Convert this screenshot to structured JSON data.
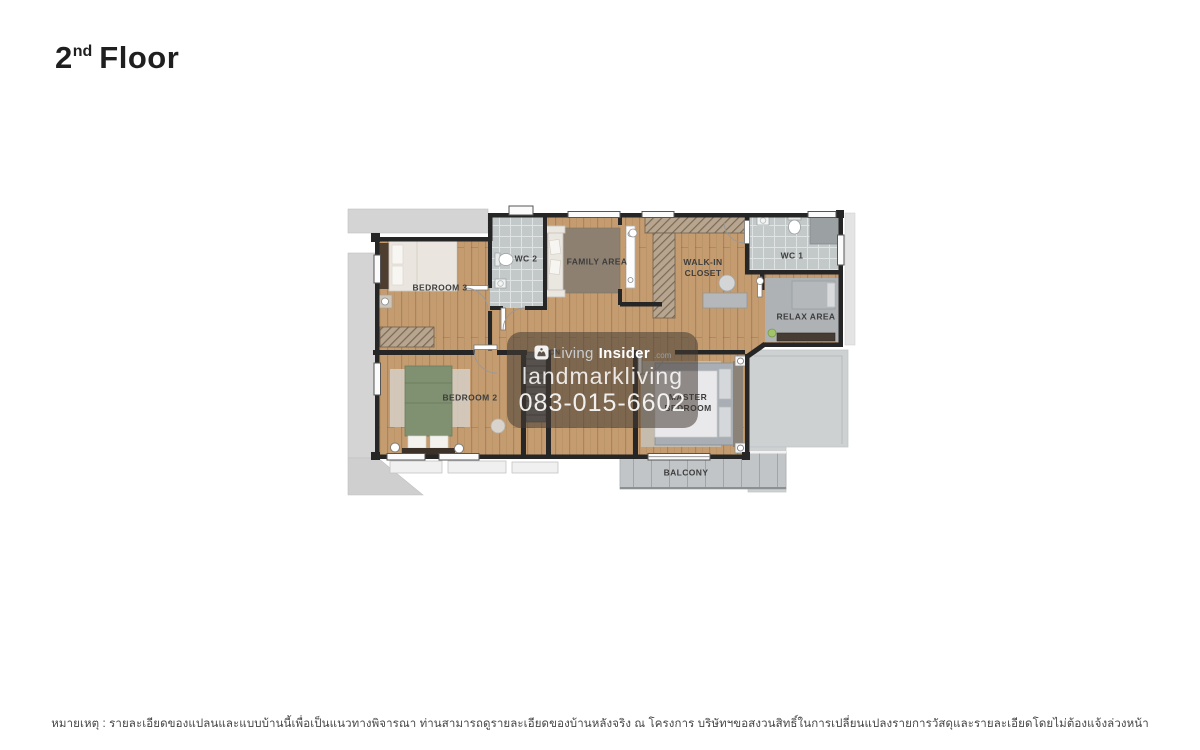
{
  "page": {
    "title": {
      "number": "2",
      "ordinal": "nd",
      "word": "Floor"
    }
  },
  "floorplan": {
    "rooms": [
      {
        "id": "bedroom-3",
        "label": "BEDROOM 3"
      },
      {
        "id": "wc-2",
        "label": "WC 2"
      },
      {
        "id": "family-area",
        "label": "FAMILY AREA"
      },
      {
        "id": "walk-in-closet",
        "label": "WALK-IN CLOSET"
      },
      {
        "id": "wc-1",
        "label": "WC 1"
      },
      {
        "id": "relax-area",
        "label": "RELAX AREA"
      },
      {
        "id": "bedroom-2",
        "label": "BEDROOM 2"
      },
      {
        "id": "master-bedroom",
        "label": "MASTER BEDROOM"
      },
      {
        "id": "balcony",
        "label": "BALCONY"
      },
      {
        "id": "stairs-down",
        "label": "DN"
      }
    ],
    "colors": {
      "wood": "#c49c70",
      "wall": "#262626",
      "wc_tile": "#c3c8c9",
      "roof_gray": "#d4d4d4",
      "balcony_gray": "#c1c5c7",
      "family_rug": "#8d8071",
      "bed_green": "#7f9170",
      "bed_gray": "#a8aeb4",
      "watermark_bg": "rgba(70,60,52,0.55)"
    }
  },
  "watermark": {
    "brand_light": "Living",
    "brand_bold": "Insider",
    "brand_domain": ".com",
    "line2": "landmarkliving",
    "phone": "083-015-6602"
  },
  "footer": {
    "note": "หมายเหตุ : รายละเอียดของแปลนและแบบบ้านนี้เพื่อเป็นแนวทางพิจารณา ท่านสามารถดูรายละเอียดของบ้านหลังจริง ณ โครงการ บริษัทฯขอสงวนสิทธิ์ในการเปลี่ยนแปลงรายการวัสดุและรายละเอียดโดยไม่ต้องแจ้งล่วงหน้า"
  }
}
